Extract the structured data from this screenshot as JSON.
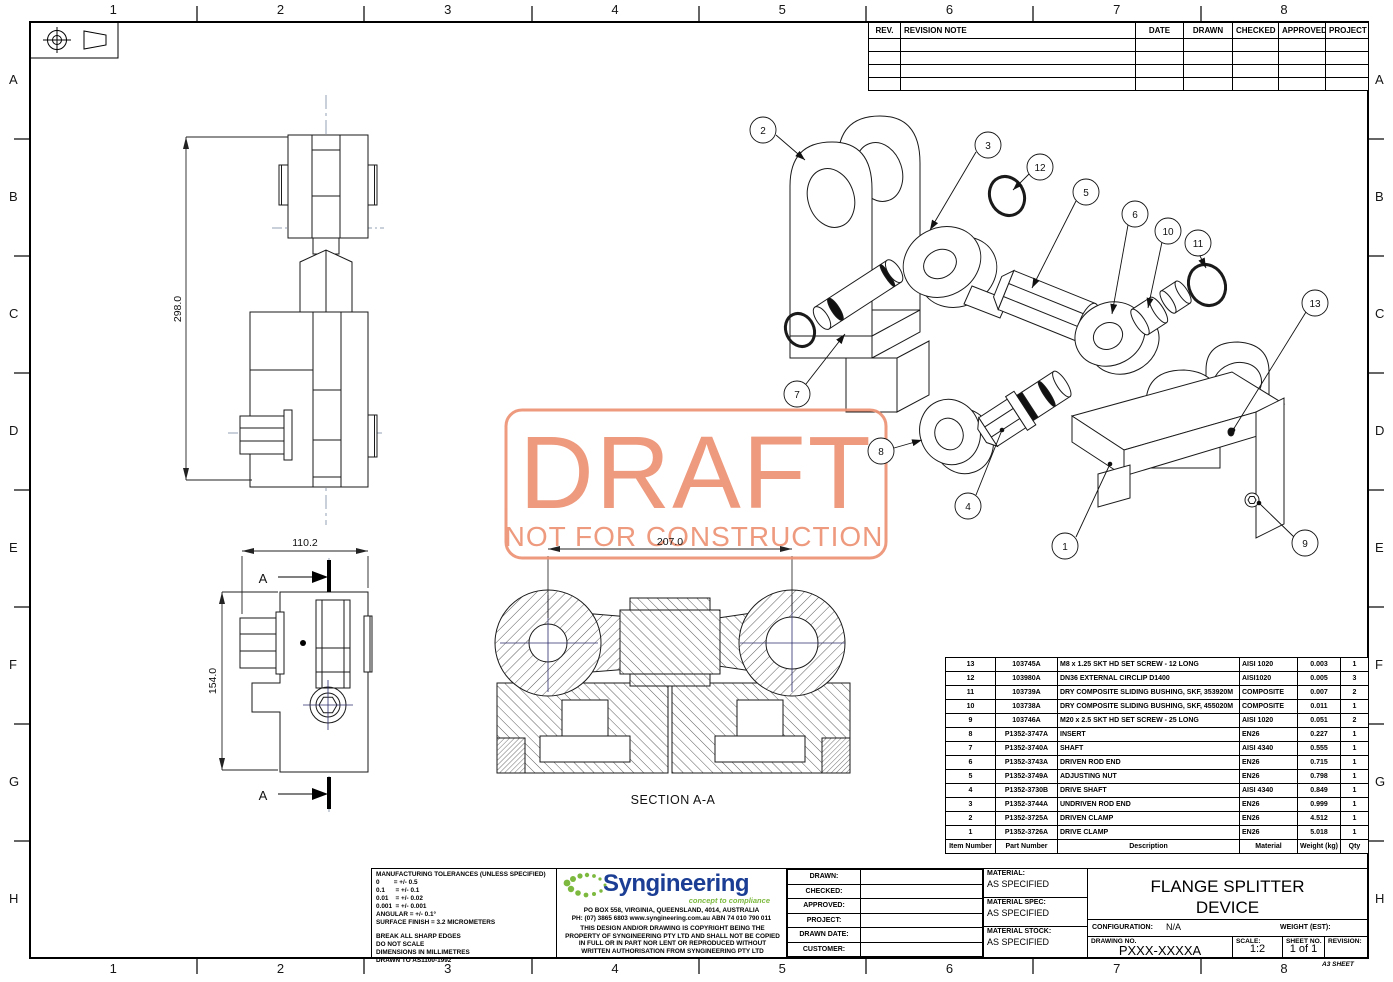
{
  "sheet": {
    "zone_numbers": [
      "1",
      "2",
      "3",
      "4",
      "5",
      "6",
      "7",
      "8"
    ],
    "zone_letters": [
      "A",
      "B",
      "C",
      "D",
      "E",
      "F",
      "G",
      "H"
    ],
    "format_label": "A3 SHEET",
    "projection_symbol": "third-angle-projection-icon"
  },
  "watermark": {
    "line1": "DRAFT",
    "line2": "NOT FOR CONSTRUCTION",
    "color": "#ED9274"
  },
  "revision_table": {
    "headers": [
      "REV.",
      "REVISION NOTE",
      "DATE",
      "DRAWN",
      "CHECKED",
      "APPROVED",
      "PROJECT"
    ],
    "empty_row_count": 4
  },
  "views": {
    "front": {
      "height_dim": "298.0"
    },
    "side": {
      "width_dim": "110.2",
      "height_dim": "154.0",
      "section_letter": "A"
    },
    "section": {
      "label": "SECTION A-A",
      "width_dim": "207.0"
    }
  },
  "balloons": {
    "b1": "1",
    "b2": "2",
    "b3": "3",
    "b4": "4",
    "b5": "5",
    "b6": "6",
    "b7": "7",
    "b8": "8",
    "b9": "9",
    "b10": "10",
    "b11": "11",
    "b12": "12",
    "b13": "13"
  },
  "bom": {
    "headers": [
      "Item Number",
      "Part Number",
      "Description",
      "Material",
      "Weight (kg)",
      "Qty"
    ],
    "rows": [
      [
        "13",
        "103745A",
        "M8 x 1.25 SKT HD SET SCREW - 12 LONG",
        "AISI 1020",
        "0.003",
        "1"
      ],
      [
        "12",
        "103980A",
        "DN36 EXTERNAL CIRCLIP D1400",
        "AISI1020",
        "0.005",
        "3"
      ],
      [
        "11",
        "103739A",
        "DRY COMPOSITE SLIDING BUSHING, SKF, 353920M",
        "COMPOSITE",
        "0.007",
        "2"
      ],
      [
        "10",
        "103738A",
        "DRY COMPOSITE SLIDING BUSHING, SKF, 455020M",
        "COMPOSITE",
        "0.011",
        "1"
      ],
      [
        "9",
        "103746A",
        "M20 x 2.5 SKT HD SET SCREW - 25 LONG",
        "AISI 1020",
        "0.051",
        "2"
      ],
      [
        "8",
        "P1352-3747A",
        "INSERT",
        "EN26",
        "0.227",
        "1"
      ],
      [
        "7",
        "P1352-3740A",
        "SHAFT",
        "AISI 4340",
        "0.555",
        "1"
      ],
      [
        "6",
        "P1352-3743A",
        "DRIVEN ROD END",
        "EN26",
        "0.715",
        "1"
      ],
      [
        "5",
        "P1352-3749A",
        "ADJUSTING NUT",
        "EN26",
        "0.798",
        "1"
      ],
      [
        "4",
        "P1352-3730B",
        "DRIVE SHAFT",
        "AISI 4340",
        "0.849",
        "1"
      ],
      [
        "3",
        "P1352-3744A",
        "UNDRIVEN ROD END",
        "EN26",
        "0.999",
        "1"
      ],
      [
        "2",
        "P1352-3725A",
        "DRIVEN CLAMP",
        "EN26",
        "4.512",
        "1"
      ],
      [
        "1",
        "P1352-3726A",
        "DRIVE CLAMP",
        "EN26",
        "5.018",
        "1"
      ]
    ]
  },
  "tolerances": {
    "title": "MANUFACTURING TOLERANCES (UNLESS SPECIFIED)",
    "lines": [
      "0        = +/- 0.5",
      "0.1      = +/- 0.1",
      "0.01    = +/- 0.02",
      "0.001  = +/- 0.001",
      "ANGULAR = +/- 0.1°",
      "SURFACE FINISH = 3.2 MICROMETERS"
    ],
    "notes": [
      "BREAK ALL SHARP EDGES",
      "DO NOT SCALE",
      "DIMENSIONS IN MILLIMETRES",
      "DRAWN TO AS1100-1992"
    ]
  },
  "company": {
    "name": "Syngineering",
    "tagline": "concept to compliance",
    "address": "PO BOX 558, VIRGINIA, QUEENSLAND, 4014, AUSTRALIA",
    "contact": "PH: (07) 3865 6803   www.syngineering.com.au   ABN 74 010 790 011",
    "copyright": "THIS DESIGN AND/OR DRAWING IS COPYRIGHT BEING THE PROPERTY OF SYNGINEERING PTY LTD AND SHALL NOT BE COPIED IN FULL OR IN PART NOR LENT OR REPRODUCED WITHOUT WRITTEN AUTHORISATION FROM SYNGINEERING PTY LTD",
    "brand_blue": "#1b3e94",
    "brand_green": "#7cb93e"
  },
  "signoff": {
    "rows": [
      {
        "label": "DRAWN:",
        "value": ""
      },
      {
        "label": "CHECKED:",
        "value": ""
      },
      {
        "label": "APPROVED:",
        "value": ""
      },
      {
        "label": "PROJECT:",
        "value": ""
      },
      {
        "label": "DRAWN DATE:",
        "value": ""
      },
      {
        "label": "CUSTOMER:",
        "value": ""
      }
    ]
  },
  "material_block": {
    "rows": [
      {
        "label": "MATERIAL:",
        "value": "AS SPECIFIED"
      },
      {
        "label": "MATERIAL SPEC:",
        "value": "AS SPECIFIED"
      },
      {
        "label": "MATERIAL STOCK:",
        "value": "AS SPECIFIED"
      }
    ]
  },
  "title_block": {
    "title_line1": "FLANGE SPLITTER",
    "title_line2": "DEVICE",
    "configuration_label": "CONFIGURATION:",
    "configuration_value": "N/A",
    "weight_label": "WEIGHT (EST):",
    "drawing_no_label": "DRAWING NO.",
    "drawing_no": "PXXX-XXXXA",
    "scale_label": "SCALE:",
    "scale_value": "1:2",
    "sheet_no_label": "SHEET NO.",
    "sheet_no_value": "1 of 1",
    "revision_label": "REVISION:"
  }
}
